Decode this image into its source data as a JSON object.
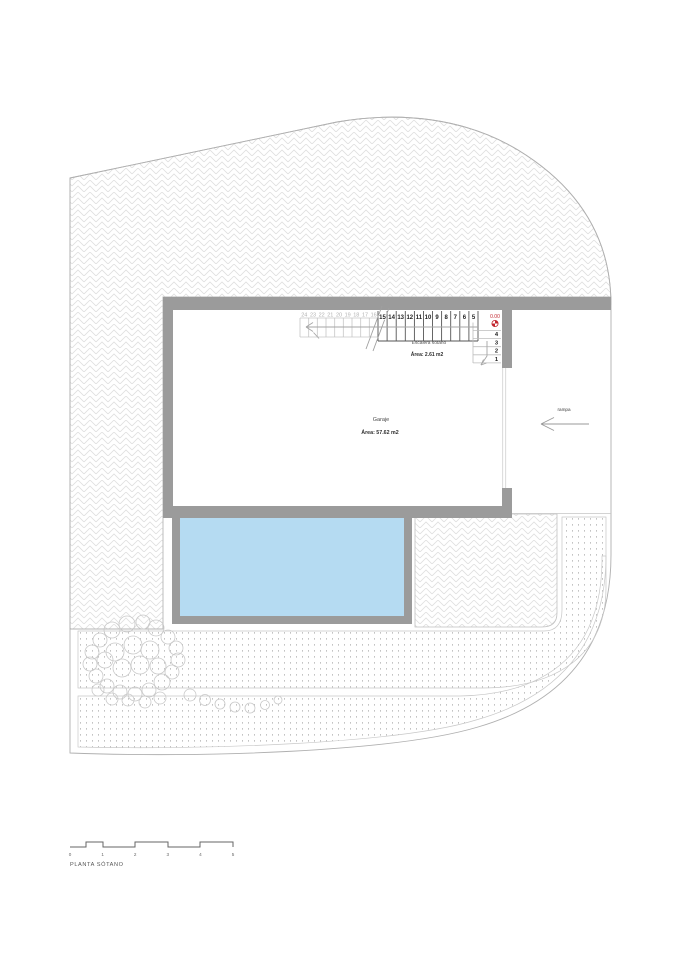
{
  "drawing": {
    "title": "PLANTA SÓTANO",
    "colors": {
      "wall": "#9b9b9b",
      "water": "#b5dbf2",
      "marker_red": "#c2252e"
    },
    "garage": {
      "label": "Garaje",
      "area": "Área: 57.62 m2"
    },
    "stair": {
      "label": "Escalera sótano",
      "area": "Área: 2.61 m2",
      "level_marker": "0.00",
      "run_numbers": [
        "24",
        "23",
        "22",
        "21",
        "20",
        "19",
        "18",
        "17",
        "16",
        "15",
        "14",
        "13",
        "12",
        "11",
        "10",
        "9",
        "8",
        "7",
        "6",
        "5"
      ],
      "corner_numbers": [
        "4",
        "3",
        "2",
        "1"
      ]
    },
    "ramp_label": "rampa",
    "scale_bar": {
      "ticks": [
        "0",
        "1",
        "2",
        "3",
        "4",
        "5"
      ]
    }
  }
}
